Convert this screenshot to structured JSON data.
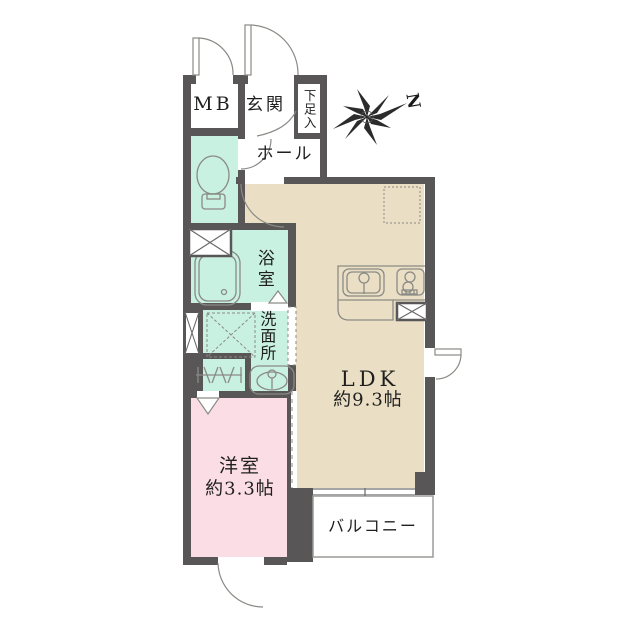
{
  "colors": {
    "wall": "#595657",
    "mint": "#c9f1e1",
    "pink": "#fbdde6",
    "tan": "#eadfc5",
    "line": "#8a8a85",
    "thin": "#9a9a96",
    "label_text": "#1f1f1f"
  },
  "compass": {
    "label": "N"
  },
  "rooms": {
    "mb": {
      "label": "MB"
    },
    "entrance": {
      "label": "玄関"
    },
    "shoe_cabinet": {
      "label": "下足入"
    },
    "hall": {
      "label": "ホール"
    },
    "bathroom": {
      "label": "浴室"
    },
    "washroom": {
      "label": "洗面所"
    },
    "ldk": {
      "label": "LDK",
      "size": "約9.3帖"
    },
    "western_room": {
      "label": "洋室",
      "size": "約3.3帖"
    },
    "balcony": {
      "label": "バルコニー"
    }
  }
}
